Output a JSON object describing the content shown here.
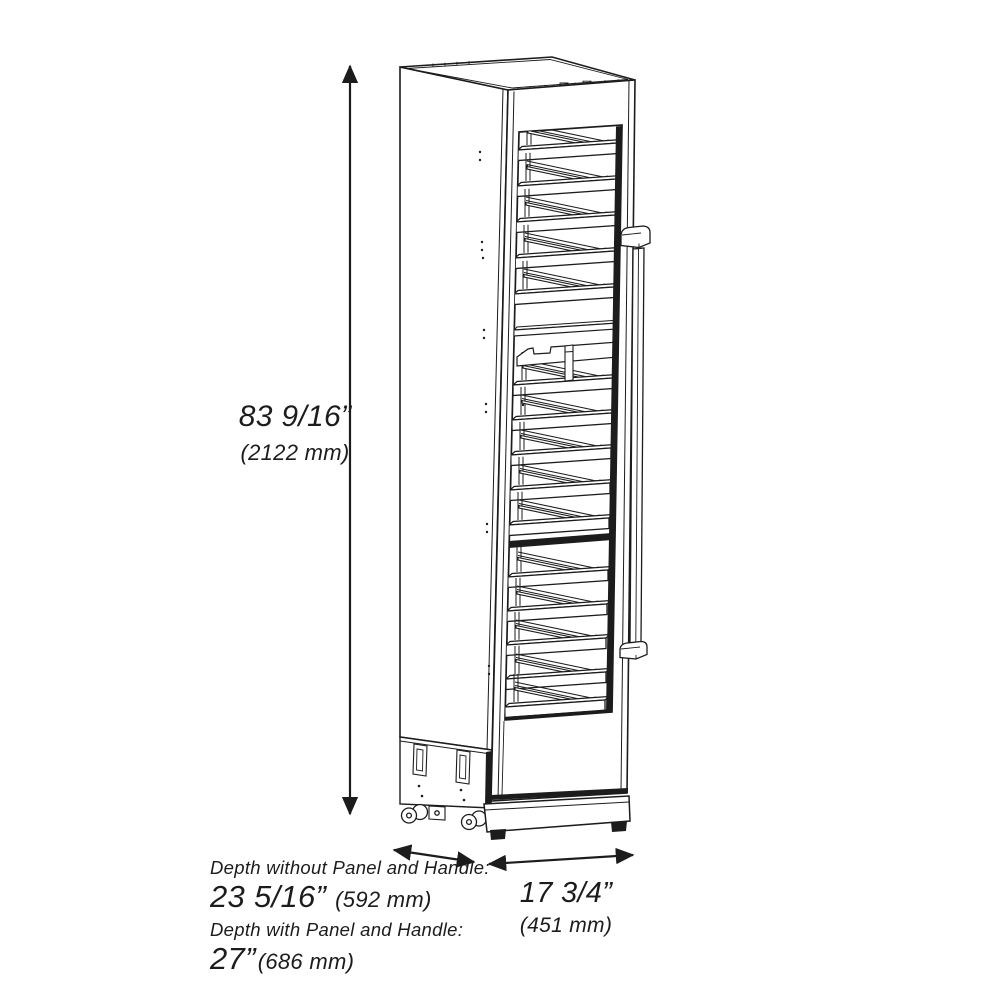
{
  "diagram_subject": "tall wine cooler cabinet line drawing, three-quarter view",
  "dimensions": {
    "height": {
      "imperial": "83 9/16”",
      "metric": "(2122 mm)"
    },
    "depth_without_panel": {
      "label": "Depth without Panel and Handle:",
      "imperial": "23 5/16”",
      "metric": "(592 mm)"
    },
    "depth_with_panel": {
      "label": "Depth with Panel and Handle:",
      "imperial": "27”",
      "metric": "(686 mm)"
    },
    "width": {
      "imperial": "17 3/4”",
      "metric": "(451 mm)"
    }
  },
  "colors": {
    "line": "#1c1c1c",
    "background": "#ffffff"
  }
}
